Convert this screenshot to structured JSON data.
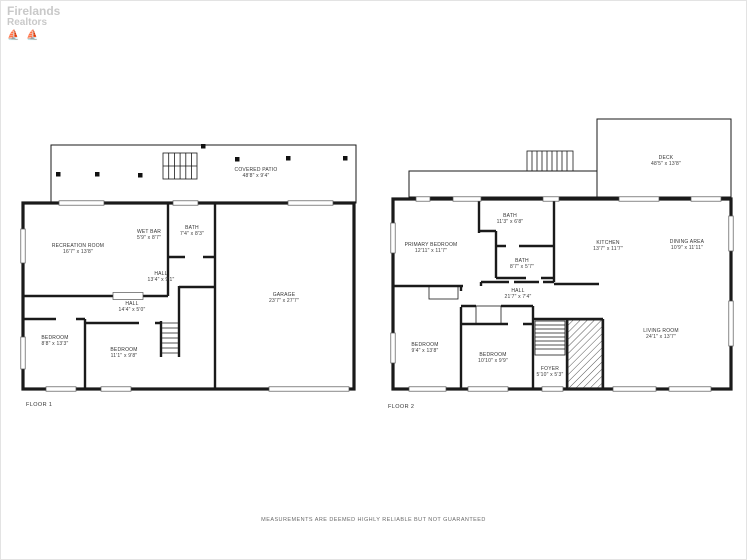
{
  "watermark": {
    "line1": "Firelands",
    "line2": "Realtors",
    "boats": "⛵ ⛵"
  },
  "floor1": {
    "label": "FLOOR 1",
    "rooms": [
      {
        "name": "COVERED PATIO",
        "dims": "48'8\" x 9'4\""
      },
      {
        "name": "RECREATION ROOM",
        "dims": "16'7\" x 13'8\""
      },
      {
        "name": "WET BAR",
        "dims": "5'9\" x 8'7\""
      },
      {
        "name": "BATH",
        "dims": "7'4\" x 8'3\""
      },
      {
        "name": "HALL",
        "dims": "13'4\" x 9'1\""
      },
      {
        "name": "HALL",
        "dims": "14'4\" x 5'0\""
      },
      {
        "name": "BEDROOM",
        "dims": "8'8\" x 13'3\""
      },
      {
        "name": "BEDROOM",
        "dims": "11'1\" x 9'8\""
      },
      {
        "name": "GARAGE",
        "dims": "23'7\" x 27'7\""
      }
    ]
  },
  "floor2": {
    "label": "FLOOR 2",
    "rooms": [
      {
        "name": "DECK",
        "dims": "48'5\" x 13'8\""
      },
      {
        "name": "PRIMARY BEDROOM",
        "dims": "12'11\" x 11'7\""
      },
      {
        "name": "BATH",
        "dims": "11'3\" x 6'8\""
      },
      {
        "name": "BATH",
        "dims": "8'7\" x 5'7\""
      },
      {
        "name": "KITCHEN",
        "dims": "13'7\" x 11'7\""
      },
      {
        "name": "DINING AREA",
        "dims": "10'9\" x 11'11\""
      },
      {
        "name": "HALL",
        "dims": "21'7\" x 7'4\""
      },
      {
        "name": "BEDROOM",
        "dims": "9'4\" x 13'8\""
      },
      {
        "name": "BEDROOM",
        "dims": "10'10\" x 9'9\""
      },
      {
        "name": "FOYER",
        "dims": "5'10\" x 5'3\""
      },
      {
        "name": "LIVING ROOM",
        "dims": "24'1\" x 13'7\""
      }
    ]
  },
  "footer": {
    "disclaimer": "MEASUREMENTS ARE DEEMED HIGHLY RELIABLE BUT NOT GUARANTEED"
  },
  "colors": {
    "wall": "#111111",
    "label_text": "#333333",
    "watermark": "#c9c9c9"
  }
}
